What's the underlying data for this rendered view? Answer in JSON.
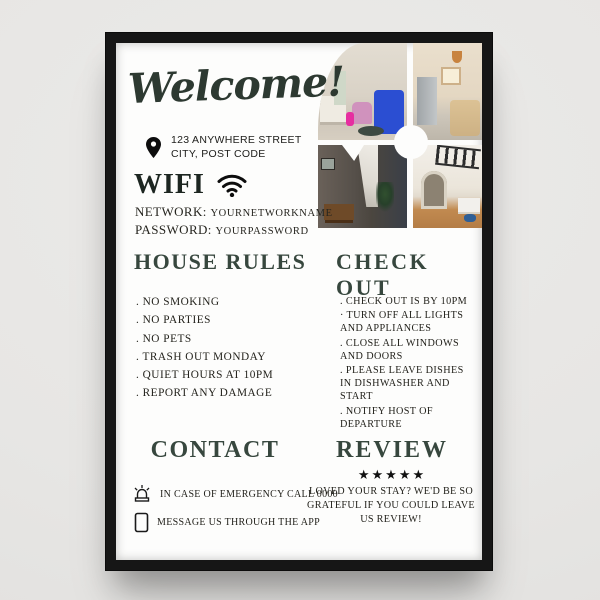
{
  "poster": {
    "welcome": "Welcome!",
    "address": {
      "line1": "123 ANYWHERE STREET",
      "line2": "CITY, POST CODE"
    },
    "wifi": {
      "title": "WIFI",
      "network_label": "NETWORK:",
      "network_value": "YOURNETWORKNAME",
      "password_label": "PASSWORD:",
      "password_value": "YOURPASSWORD"
    },
    "house_rules": {
      "title": "HOUSE RULES",
      "items": [
        ". NO SMOKING",
        ". NO PARTIES",
        ". NO PETS",
        ". TRASH OUT MONDAY",
        ". QUIET HOURS AT 10PM",
        ". REPORT ANY DAMAGE"
      ]
    },
    "check_out": {
      "title": "CHECK OUT",
      "items": [
        ". CHECK OUT IS BY 10PM",
        "· TURN OFF ALL LIGHTS AND APPLIANCES",
        ". CLOSE ALL WINDOWS AND DOORS",
        ". PLEASE LEAVE DISHES IN DISHWASHER AND START",
        ". NOTIFY HOST OF DEPARTURE"
      ]
    },
    "contact": {
      "title": "CONTACT",
      "emergency": "IN CASE OF EMERGENCY CALL 0000",
      "app": "MESSAGE US THROUGH THE APP"
    },
    "review": {
      "title": "REVIEW",
      "stars": "★★★★★",
      "text": "LOVED YOUR STAY? WE'D BE SO GRATEFUL IF YOU COULD LEAVE US REVIEW!"
    },
    "photos": [
      "living-room-with-blue-sofa",
      "kitchen-with-fridge",
      "dining-area-with-stairs",
      "living-room-with-arch-doorway"
    ]
  },
  "colors": {
    "heading_green": "#37473e",
    "text_dark": "#23221c",
    "frame_black": "#161616",
    "poster_white": "#fdfdfc",
    "wall_gray": "#e7e6e4",
    "star_black": "#111111"
  }
}
